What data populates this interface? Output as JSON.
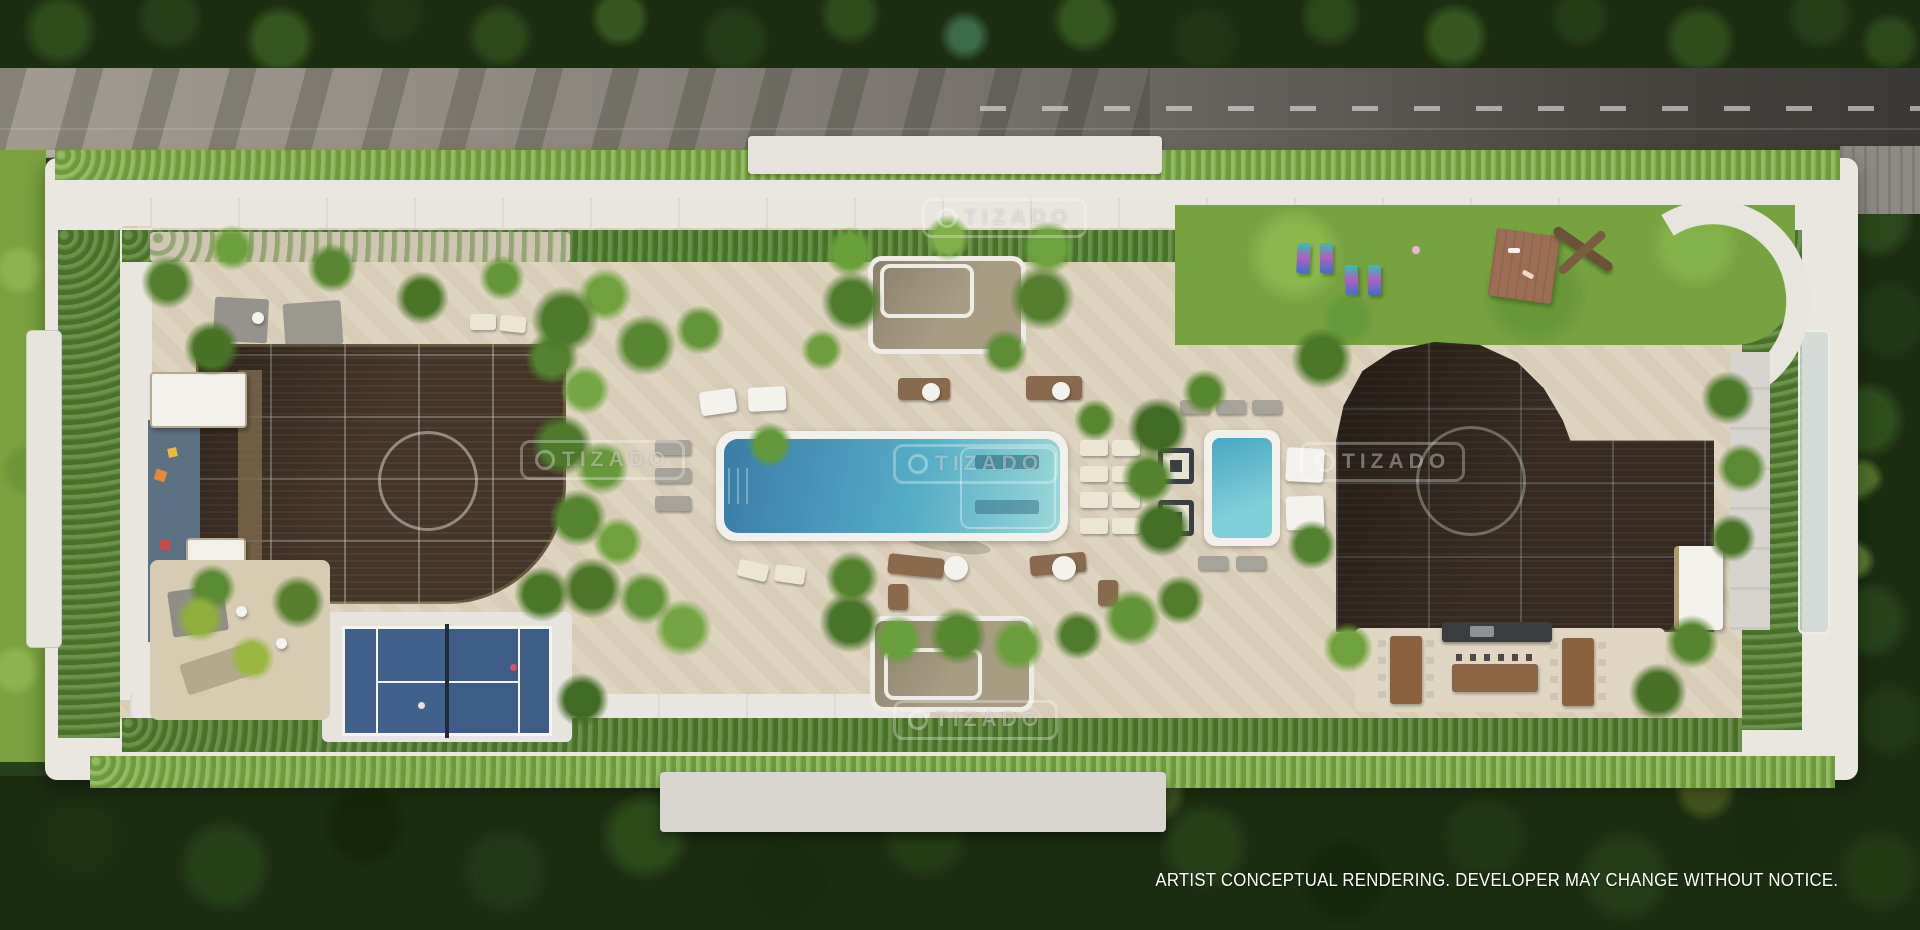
{
  "scene": {
    "description": "Aerial top-down architectural rendering of a rooftop amenity deck: lap pool, spa, padel court, bronze glass skylight roofs, gardens, lawn with yoga mats, outdoor dining, surrounded by a tree-lined road and dense forest."
  },
  "watermark": {
    "label": "TIZADO"
  },
  "disclaimer": {
    "text": "ARTIST CONCEPTUAL RENDERING. DEVELOPER MAY CHANGE WITHOUT NOTICE."
  },
  "palette": {
    "pool_water": "#4a9abd",
    "spa_water": "#5fb9cc",
    "court_blue": "#3f6089",
    "glass_roof_bronze": "#453527",
    "glass_roof_dark": "#372b21",
    "lawn_green": "#76a23f",
    "hedge_green": "#7fb047",
    "paving_cream": "#ddd2bc",
    "walkway_white": "#e8e6df",
    "parapet_white": "#e9e7e0",
    "road_asphalt": "#6e6a64",
    "forest_dark": "#1c2e10"
  }
}
